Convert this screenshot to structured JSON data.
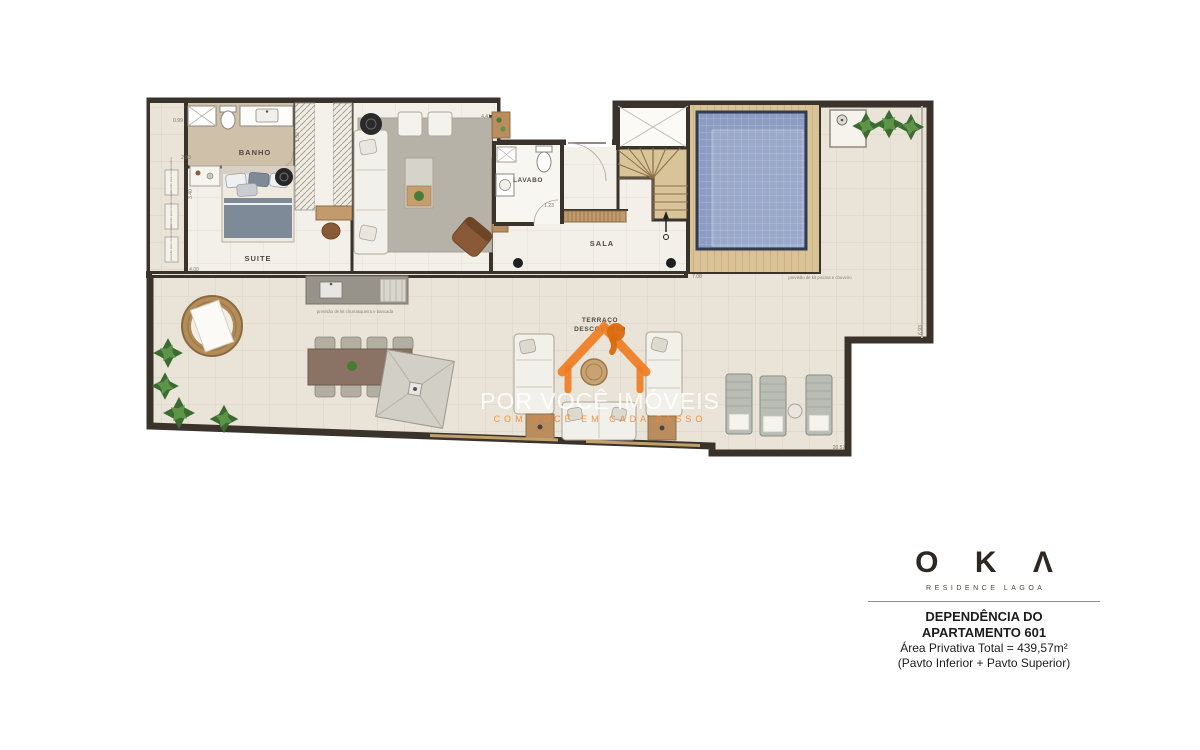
{
  "plan": {
    "rooms": {
      "banho": "BANHO",
      "suite": "SUITE",
      "lavabo": "LAVABO",
      "sala": "SALA",
      "terraco_line1": "TERRAÇO",
      "terraco_line2": "DESCOBERTO"
    },
    "annotations": {
      "churrasqueira": "previsão de kit churrasqueira e bancada",
      "piscina": "previsão de kit piscina e chuveiro",
      "condensadora": "previsão para condensadora",
      "dims": {
        "left_top": "0.99",
        "left_mid": "2.93",
        "left_lower": "3.40",
        "left_bottom": "4.00",
        "closet": "1.52",
        "sala_top": "4.41",
        "lavabo_door": "1.23",
        "deck_bottom": "7.08",
        "terrace_right": "6.93",
        "bottom_right": "20.57"
      }
    }
  },
  "watermark": {
    "main": "POR VOCÊ IMÓVEIS",
    "tagline": "COM VOCÊ EM CADA PASSO"
  },
  "branding": {
    "logo_text": "O K Λ",
    "logo_subtitle": "RESIDENCE LAGOA",
    "title_line1": "DEPENDÊNCIA DO",
    "title_line2": "APARTAMENTO 601",
    "area_line": "Área Privativa Total = 439,57m²",
    "pavto_line": "(Pavto Inferior + Pavto Superior)"
  },
  "colors": {
    "accent_orange": "#EF7D22",
    "wall": "#3A332C",
    "pool_water": "#8C9CC3",
    "deck_wood": "#D9C396",
    "floor_tile": "#E9E4D7"
  }
}
